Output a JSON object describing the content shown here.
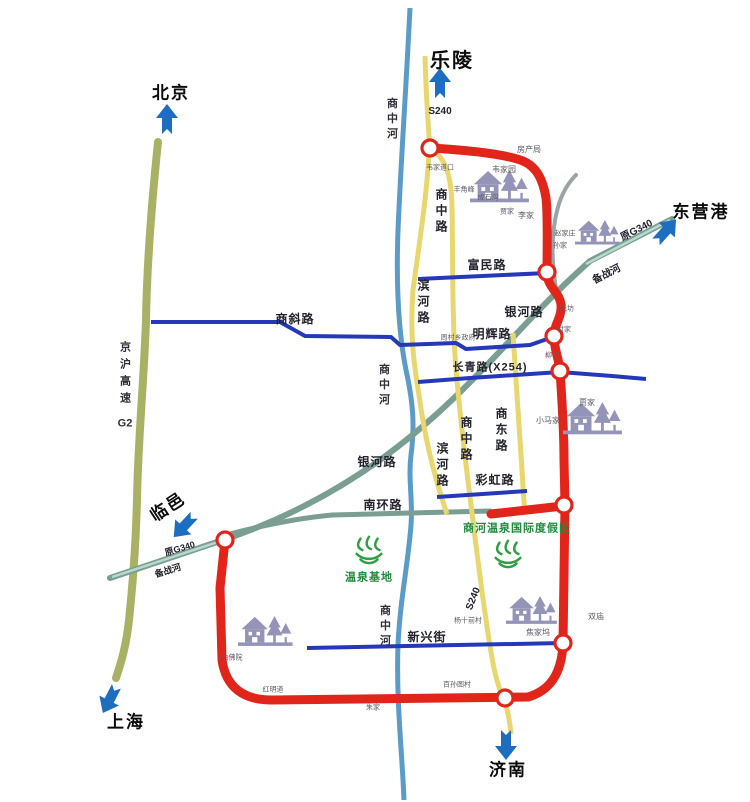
{
  "destinations": {
    "beijing": "北京",
    "shanghai": "上海",
    "leling": "乐陵",
    "dongying_port": "东营港",
    "jinan": "济南",
    "linyi": "临邑"
  },
  "highways": {
    "jinghu_expressway": "京沪高速",
    "jinghu_code": "G2",
    "s240": "S240",
    "old_g340": "原G340",
    "changqing_x254": "长青路(X254)"
  },
  "roads": {
    "fumin": "富民路",
    "binhe": "滨河路",
    "shangzhong": "商中路",
    "shangdong": "商东路",
    "minghui": "明辉路",
    "caihong": "彩虹路",
    "nanhuan": "南环路",
    "xinxing": "新兴街",
    "shangxie": "商斜路",
    "yinhe": "银河路"
  },
  "rivers": {
    "shangzhonghe": "商中河",
    "beizhanhe": "备战河"
  },
  "resort": {
    "zone": "商河温泉国际度假区",
    "base": "温泉基地"
  },
  "villages": {
    "fangchanju": "房产局",
    "weijiayuan": "韦家园",
    "weijiadaokou": "韦家道口",
    "fengjiaofeng": "丰角峰",
    "chengshigou": "成石沟",
    "jiajia_n": "贾家",
    "lijia": "李家",
    "zhaojiazhuang": "赵家庄",
    "sunjia": "孙家",
    "zhifang": "纸坊",
    "fujia": "付家",
    "liuhang": "柳行",
    "xiaomajia": "小马家",
    "jiajia_e": "贾家",
    "shuangmiao": "双庙",
    "jiaojiawu": "焦家坞",
    "yangshiqiancun": "杨十前村",
    "baifoyuan": "白佛院",
    "hongmingdao": "红明道",
    "zhujia": "朱家",
    "baisuntucun": "百孙图村",
    "township_gov": "周村乡政府"
  },
  "colors": {
    "ring_road": "#e1251b",
    "provincial_road": "#e8d76f",
    "city_road": "#2438b8",
    "river": "#5b9bc8",
    "old_road": "#7a9e92",
    "expressway": "#a9b264",
    "arrow": "#1d6ec0",
    "resort_text": "#1f8a3d",
    "village_icon": "#9494b8"
  }
}
